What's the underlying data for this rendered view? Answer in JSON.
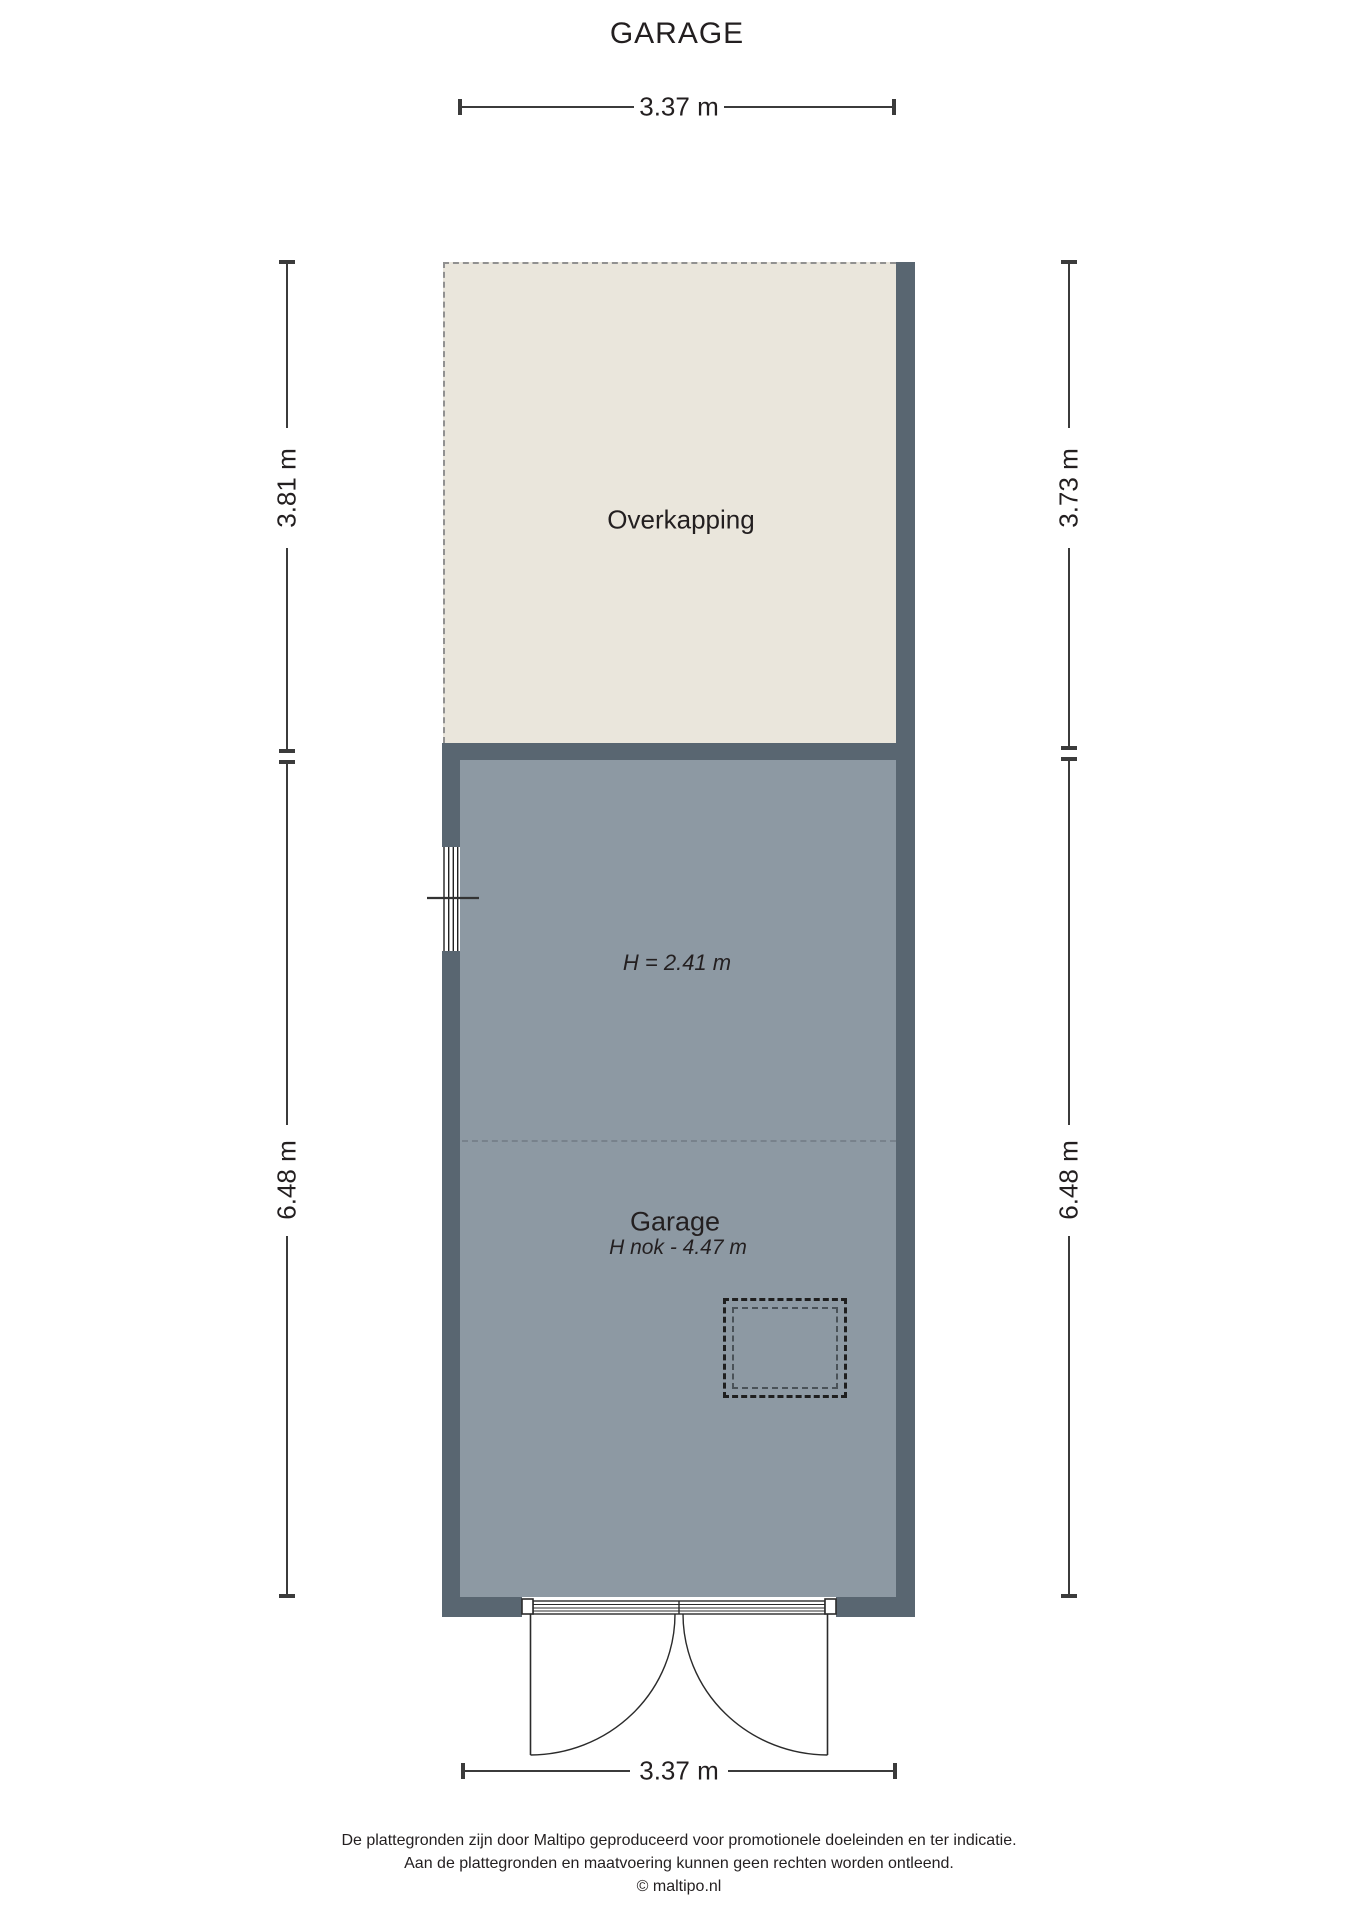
{
  "title": "GARAGE",
  "plan": {
    "overkapping_label": "Overkapping",
    "garage_label": "Garage",
    "garage_height": "H = 2.41 m",
    "garage_ridge_height": "H nok - 4.47 m"
  },
  "dimensions": {
    "top_width": "3.37 m",
    "bottom_width": "3.37 m",
    "left_upper": "3.81 m",
    "left_lower": "6.48 m",
    "right_upper": "3.73 m",
    "right_lower": "6.48 m"
  },
  "colors": {
    "wall": "#596671",
    "garage_floor": "#8d99a3",
    "overkapping_fill": "#eae6dc",
    "dimension_line": "#3b3b3b",
    "text": "#231f20"
  },
  "footer": {
    "line1": "De plattegronden zijn door Maltipo geproduceerd voor promotionele doeleinden en ter indicatie.",
    "line2": "Aan de plattegronden en maatvoering kunnen geen rechten worden ontleend.",
    "line3": "© maltipo.nl"
  }
}
